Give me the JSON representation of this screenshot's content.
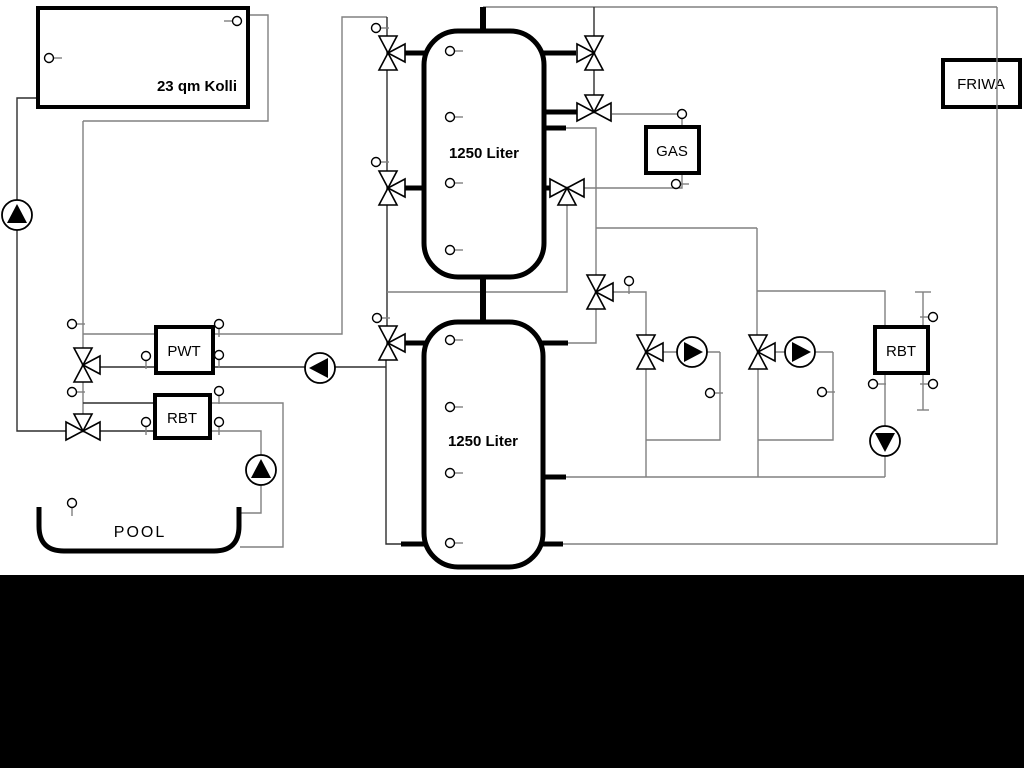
{
  "diagram_title": "solar-buffer-heating-scheme",
  "labels": {
    "collector": "23 qm Kolli",
    "buffer_tank_top": "1250 Liter",
    "buffer_tank_bottom": "1250 Liter",
    "gas_boiler": "GAS",
    "friwa": "FRIWA",
    "pwt": "PWT",
    "rbt_pool": "RBT",
    "rbt_heating": "RBT",
    "pool": "POOL"
  },
  "colors": {
    "background": "#ffffff",
    "letterbox": "#000000",
    "line_gray": "#808080",
    "line_dark": "#2e2e2e",
    "component_stroke": "#000000",
    "component_fill": "#ffffff"
  },
  "components": {
    "valves": [
      {
        "name": "three-way-valve-tank1-top-icon",
        "type": "VR",
        "x": 388,
        "y": 53
      },
      {
        "name": "three-way-valve-tank1-mid-icon",
        "type": "VR",
        "x": 388,
        "y": 188
      },
      {
        "name": "three-way-valve-tank2-icon",
        "type": "VR",
        "x": 388,
        "y": 343
      },
      {
        "name": "three-way-valve-friwa-icon",
        "type": "VL",
        "x": 594,
        "y": 53
      },
      {
        "name": "three-way-valve-gas-supply-icon",
        "type": "HT",
        "x": 594,
        "y": 112
      },
      {
        "name": "three-way-valve-gas-return-icon",
        "type": "HB",
        "x": 567,
        "y": 188
      },
      {
        "name": "three-way-valve-heating-supply-icon",
        "type": "VR",
        "x": 596,
        "y": 292
      },
      {
        "name": "three-way-mixing-valve-circuit1-icon",
        "type": "VR",
        "x": 646,
        "y": 352
      },
      {
        "name": "three-way-mixing-valve-circuit2-icon",
        "type": "VR",
        "x": 758,
        "y": 352
      },
      {
        "name": "three-way-valve-pwt-icon",
        "type": "VR",
        "x": 83,
        "y": 365
      },
      {
        "name": "three-way-valve-pool-icon",
        "type": "HT",
        "x": 83,
        "y": 431
      }
    ],
    "pumps": [
      {
        "name": "solar-pump-icon",
        "dir": "up",
        "x": 17,
        "y": 215
      },
      {
        "name": "buffer-charge-pump-icon",
        "dir": "left",
        "x": 320,
        "y": 368
      },
      {
        "name": "pool-pump-icon",
        "dir": "up",
        "x": 261,
        "y": 470
      },
      {
        "name": "heating-circuit1-pump-icon",
        "dir": "right",
        "x": 692,
        "y": 352
      },
      {
        "name": "heating-circuit2-pump-icon",
        "dir": "right",
        "x": 800,
        "y": 352
      },
      {
        "name": "rbt-heating-pump-icon",
        "dir": "down",
        "x": 885,
        "y": 441
      }
    ],
    "sensors": [
      {
        "name": "sensor-collector-left-icon",
        "x": 49,
        "y": 58,
        "stem": "right"
      },
      {
        "name": "sensor-collector-right-icon",
        "x": 237,
        "y": 21,
        "stem": "left"
      },
      {
        "name": "sensor-valve-column-1-icon",
        "x": 376,
        "y": 28,
        "stem": "right"
      },
      {
        "name": "sensor-valve-column-2-icon",
        "x": 376,
        "y": 162,
        "stem": "right"
      },
      {
        "name": "sensor-valve-column-3-icon",
        "x": 377,
        "y": 318,
        "stem": "right"
      },
      {
        "name": "sensor-solar-drop-1-icon",
        "x": 72,
        "y": 324,
        "stem": "right"
      },
      {
        "name": "sensor-solar-drop-2-icon",
        "x": 72,
        "y": 392,
        "stem": "right"
      },
      {
        "name": "sensor-tank1-1-icon",
        "x": 450,
        "y": 51,
        "stem": "right"
      },
      {
        "name": "sensor-tank1-2-icon",
        "x": 450,
        "y": 117,
        "stem": "right"
      },
      {
        "name": "sensor-tank1-3-icon",
        "x": 450,
        "y": 183,
        "stem": "right"
      },
      {
        "name": "sensor-tank1-4-icon",
        "x": 450,
        "y": 250,
        "stem": "right"
      },
      {
        "name": "sensor-tank2-1-icon",
        "x": 450,
        "y": 340,
        "stem": "right"
      },
      {
        "name": "sensor-tank2-2-icon",
        "x": 450,
        "y": 407,
        "stem": "right"
      },
      {
        "name": "sensor-tank2-3-icon",
        "x": 450,
        "y": 473,
        "stem": "right"
      },
      {
        "name": "sensor-tank2-4-icon",
        "x": 450,
        "y": 543,
        "stem": "right"
      },
      {
        "name": "sensor-pwt-left-icon",
        "x": 146,
        "y": 356,
        "stem": "down"
      },
      {
        "name": "sensor-pwt-top-right-icon",
        "x": 219,
        "y": 324,
        "stem": "down"
      },
      {
        "name": "sensor-pwt-right-icon",
        "x": 219,
        "y": 355,
        "stem": "down"
      },
      {
        "name": "sensor-rbt-pool-left-icon",
        "x": 146,
        "y": 422,
        "stem": "down"
      },
      {
        "name": "sensor-rbt-pool-top-icon",
        "x": 219,
        "y": 391,
        "stem": "down"
      },
      {
        "name": "sensor-rbt-pool-right-icon",
        "x": 219,
        "y": 422,
        "stem": "down"
      },
      {
        "name": "sensor-heating-supply-icon",
        "x": 629,
        "y": 281,
        "stem": "down"
      },
      {
        "name": "sensor-gas-supply-icon",
        "x": 682,
        "y": 114,
        "stem": "none"
      },
      {
        "name": "sensor-gas-return-icon",
        "x": 676,
        "y": 184,
        "stem": "right"
      },
      {
        "name": "sensor-circuit1-bypass-icon",
        "x": 710,
        "y": 393,
        "stem": "right"
      },
      {
        "name": "sensor-circuit2-bypass-icon",
        "x": 822,
        "y": 392,
        "stem": "right"
      },
      {
        "name": "sensor-rbt-heating-left-icon",
        "x": 873,
        "y": 384,
        "stem": "right"
      },
      {
        "name": "sensor-heating-conn-1-icon",
        "x": 933,
        "y": 317,
        "stem": "left"
      },
      {
        "name": "sensor-heating-conn-2-icon",
        "x": 933,
        "y": 384,
        "stem": "left"
      },
      {
        "name": "sensor-pool-icon",
        "x": 72,
        "y": 503,
        "stem": "down"
      }
    ]
  }
}
